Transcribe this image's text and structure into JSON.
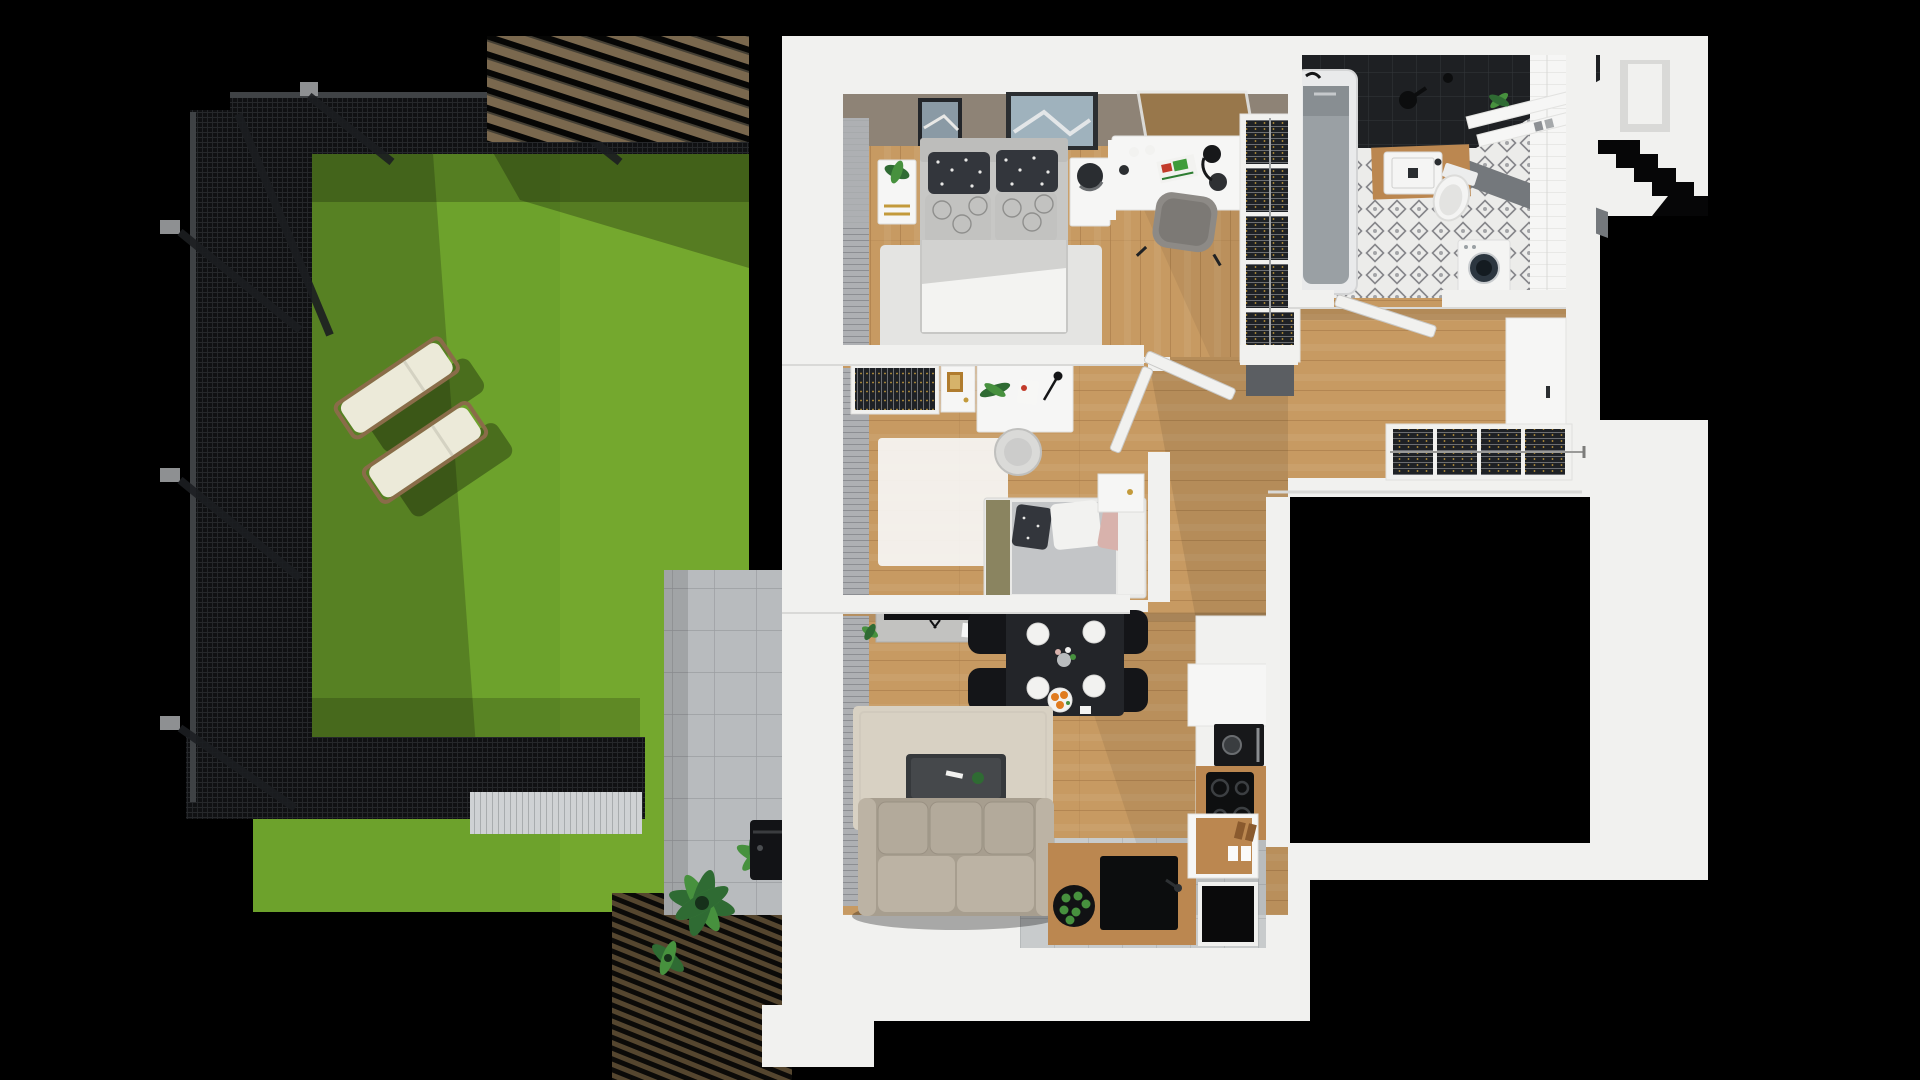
{
  "scene": {
    "title": "Top-down 3D floor plan of a one-level apartment with adjoining fenced garden",
    "type": "architectural-3d-render",
    "view": "top-down dollhouse",
    "canvas": {
      "width": 1920,
      "height": 1080
    }
  },
  "colors": {
    "bg": "#000000",
    "lawn": "#6da22c",
    "lawnLight": "#7aad32",
    "fenceDark": "#101113",
    "fenceMesh": "#26282b",
    "fenceRail": "#3f4245",
    "postGrey": "#8e9092",
    "pergolaWood": "#7a684e",
    "deckWood": "#55462f",
    "patio": "#b8bbbe",
    "patioLine": "#9b9ea1",
    "wall": "#f1f1ef",
    "wallEdge": "#d9d9d7",
    "taupe": "#8e8376",
    "wood": "#c79a62",
    "woodLine": "#a87c48",
    "rugGrey": "#e4e4e2",
    "rugBeige": "#d8d1c3",
    "sofa": "#a79e8f",
    "sofaLight": "#bcb3a4",
    "charcoal": "#232529",
    "blackObj": "#121316",
    "plate": "#f2f2f0",
    "orange": "#e07b1f",
    "kWood": "#bb8750",
    "tileGrey": "#c8cbcc",
    "tileLine": "#abaeb0",
    "bathBlack": "#1e2023",
    "bathTileLine": "#34373b",
    "bathFloor": "#ececea",
    "bathMotif": "#85868a",
    "tub": "#9aa0a4",
    "greyBand": "#74787c",
    "chrome": "#c6c9cc",
    "clothes": "#1e2125",
    "clothesLine": "#b9bcbe",
    "gold": "#c39a3b",
    "plant": "#2f6b33",
    "plantLight": "#47913e",
    "lounger": "#ecead9",
    "loungerWood": "#8a6c49",
    "curtain": "#aeb0b3",
    "matGrey": "#5b5e62",
    "whiteObj": "#f6f6f5",
    "duvet": "#d2d2d0",
    "pillowDark": "#33363c",
    "pillowGrey": "#c2c2c0",
    "olive": "#8a8460",
    "pink": "#d8b2ac"
  },
  "garden": {
    "label": "Fenced garden with lawn, pergola, patio and sun loungers",
    "items": [
      {
        "name": "lawn",
        "label": "Green lawn"
      },
      {
        "name": "mesh-fence",
        "label": "Black mesh fence with posts and braces"
      },
      {
        "name": "pergola",
        "label": "Wood-slat pergola, top right of garden"
      },
      {
        "name": "sun-loungers",
        "label": "Two white sun loungers",
        "count": 2
      },
      {
        "name": "concrete-patio",
        "label": "Concrete tile patio along house wall"
      },
      {
        "name": "wood-deck",
        "label": "Dark wood deck, bottom right"
      },
      {
        "name": "plants",
        "label": "Tropical plants"
      },
      {
        "name": "grill",
        "label": "Black grill unit"
      }
    ]
  },
  "apartment": {
    "label": "Apartment interior, top-down 3D view",
    "rooms": [
      {
        "id": "bedroom",
        "label": "Main bedroom",
        "furniture": [
          "double-bed",
          "dotted-pillows",
          "patterned-pillows",
          "nightstand-left-with-plant",
          "nightstand-right-with-lamp",
          "wall-pictures",
          "rug",
          "desk-with-accessories",
          "desk-chair",
          "open-wardrobe-5-shelves",
          "window-blinds"
        ]
      },
      {
        "id": "kids-room",
        "label": "Second bedroom / study",
        "furniture": [
          "open-wardrobe",
          "small-cabinet",
          "desk-with-plant-and-lamp",
          "round-chair",
          "white-rug",
          "single-bed-with-pink-pillow",
          "nightstand"
        ]
      },
      {
        "id": "living-room",
        "label": "Living room with dining area",
        "furniture": [
          "tv-sideboard",
          "dining-table",
          "dining-chairs-x4",
          "plates-x4",
          "fruit-plate",
          "vase",
          "beige-rug",
          "coffee-table",
          "three-seat-sofa",
          "window-blinds"
        ]
      },
      {
        "id": "kitchen",
        "label": "Kitchen corner",
        "furniture": [
          "tall-unit",
          "built-in-oven",
          "cooktop-4-burners",
          "island-with-black-sink",
          "counter-with-jars",
          "grey-tile-floor",
          "black-floor-mat"
        ]
      },
      {
        "id": "bathroom",
        "label": "Bathroom",
        "furniture": [
          "bathtub",
          "shower-fixtures",
          "black-wall-tiles",
          "patterned-tile-floor",
          "wood-vanity-with-sink",
          "toilet",
          "washing-machine",
          "wall-shelves-with-plant",
          "white-tile-wall"
        ]
      },
      {
        "id": "hallway",
        "label": "Hallway",
        "furniture": [
          "wardrobe-closet-4-sections",
          "shoe-cabinet",
          "swing-doors-x3",
          "dark-doormat"
        ]
      },
      {
        "id": "entry",
        "label": "Entry / landing with steps",
        "furniture": [
          "wall-niche",
          "black-steps"
        ]
      }
    ]
  }
}
